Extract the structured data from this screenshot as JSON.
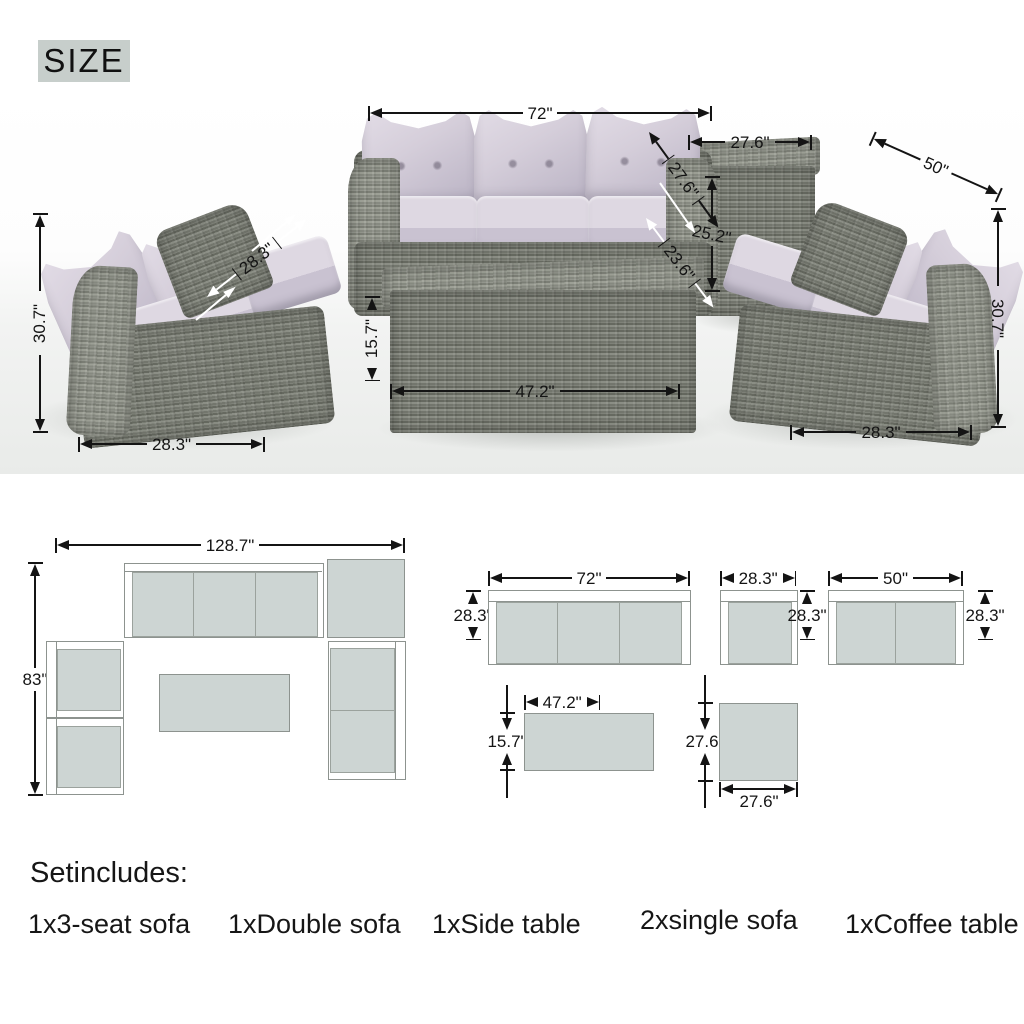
{
  "title": {
    "label": "SIZE"
  },
  "photo_dims": {
    "sofa3_width": "72\"",
    "side_table_width": "27.6\"",
    "double_sofa_width": "50\"",
    "sofa3_depth": "27.6\"",
    "side_table_height": "25.2\"",
    "seat_depth": "23.6\"",
    "left_seat_width": "28.3\"",
    "left_sofa_height": "30.7\"",
    "left_sofa_width": "28.3\"",
    "coffee_table_height": "15.7\"",
    "coffee_table_width": "47.2\"",
    "right_sofa_height": "30.7\"",
    "right_sofa_width": "28.3\""
  },
  "floor_plan": {
    "overall_width": "128.7\"",
    "overall_depth": "83\""
  },
  "unit_plans": {
    "sofa3": {
      "width": "72\"",
      "depth": "28.3\""
    },
    "single": {
      "width": "28.3\"",
      "depth": "28.3\""
    },
    "double": {
      "width": "50\"",
      "depth": "28.3\""
    },
    "coffee": {
      "width": "47.2\"",
      "depth": "15.7\""
    },
    "side": {
      "width": "27.6\"",
      "depth": "27.6\""
    }
  },
  "includes": {
    "heading": "Setincludes:",
    "items": [
      "1x3-seat sofa",
      "1xDouble sofa",
      "1xSide table",
      "2xsingle sofa",
      "1xCoffee table"
    ]
  },
  "colors": {
    "accent_box": "#c7cecb",
    "plan_fill": "#cdd5d3",
    "wicker": "#777a71",
    "cushion": "#d5cfda",
    "dimension": "#141414"
  }
}
